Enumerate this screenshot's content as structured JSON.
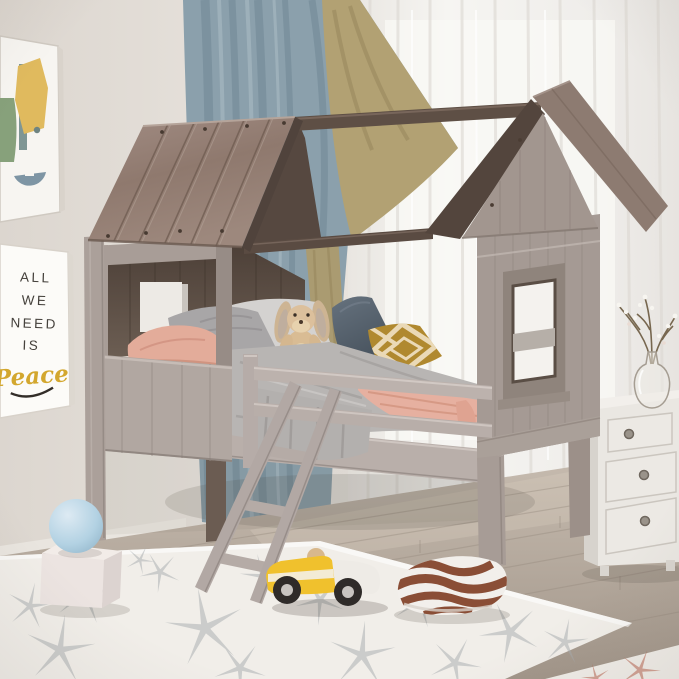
{
  "scene": {
    "type": "product-photo",
    "subject": "Kids house-frame twin loft bed with plank roof, side windows, guardrail and angled ladder, staged in a bright bedroom"
  },
  "wall_art": {
    "abstract_poster": {
      "name": "abstract-shapes-art-print",
      "colors": {
        "mustard": "#e0ba5e",
        "teal_bar": "#7f9694",
        "green_arch": "#87a17b",
        "slate_arc": "#7e95a4"
      }
    },
    "peace_poster": {
      "line1": "ALL",
      "line2": "WE",
      "line3": "NEED",
      "line4": "IS",
      "script_word": "Peace",
      "script_color": "#d3a72e"
    }
  },
  "bed": {
    "name": "house-loft-bed",
    "wood_color": "#a89d97",
    "roof_plank_color": "#968177",
    "dark_beam_color": "#5a4b42",
    "interior_color": "#584a40"
  },
  "textiles": {
    "gray_blanket": "#b8b5b3",
    "peach_blanket": "#e6b0a0",
    "peach_pillow": "#e3ac9a",
    "gray_pillow": "#a8a6a7",
    "navy_pillow": "#55616e",
    "gold_pillow": "#b0892f",
    "gold_pillow_pattern": "#ead9b6"
  },
  "room": {
    "wall_color": "#e3ded8",
    "floor_color": "#b4a89c",
    "curtain_color": "#8ba0ac",
    "curtain_trim_color": "#b2a173",
    "sheer_color": "#f1efec",
    "rug_color": "#f1eee9",
    "rug_star_color": "#a7acaf"
  },
  "objects": {
    "plush_bunny": {
      "name": "plush-bunny",
      "color": "#d9bc94"
    },
    "blue_ball": {
      "name": "blue-ball",
      "color": "#b5d4e6"
    },
    "white_block": {
      "name": "white-block",
      "color": "#ece4e1"
    },
    "toy_car": {
      "name": "yellow-toy-race-car",
      "body": "#f0c12d",
      "rear": "#eeebe6"
    },
    "striped_pillow": {
      "name": "brown-wave-floor-pillow",
      "base": "#f2efeb",
      "stripe": "#8a4e36"
    },
    "dresser": {
      "name": "white-dresser",
      "color": "#eae7e2",
      "drawers": 3
    },
    "vase": {
      "name": "glass-vase-with-blossom-branches"
    }
  }
}
